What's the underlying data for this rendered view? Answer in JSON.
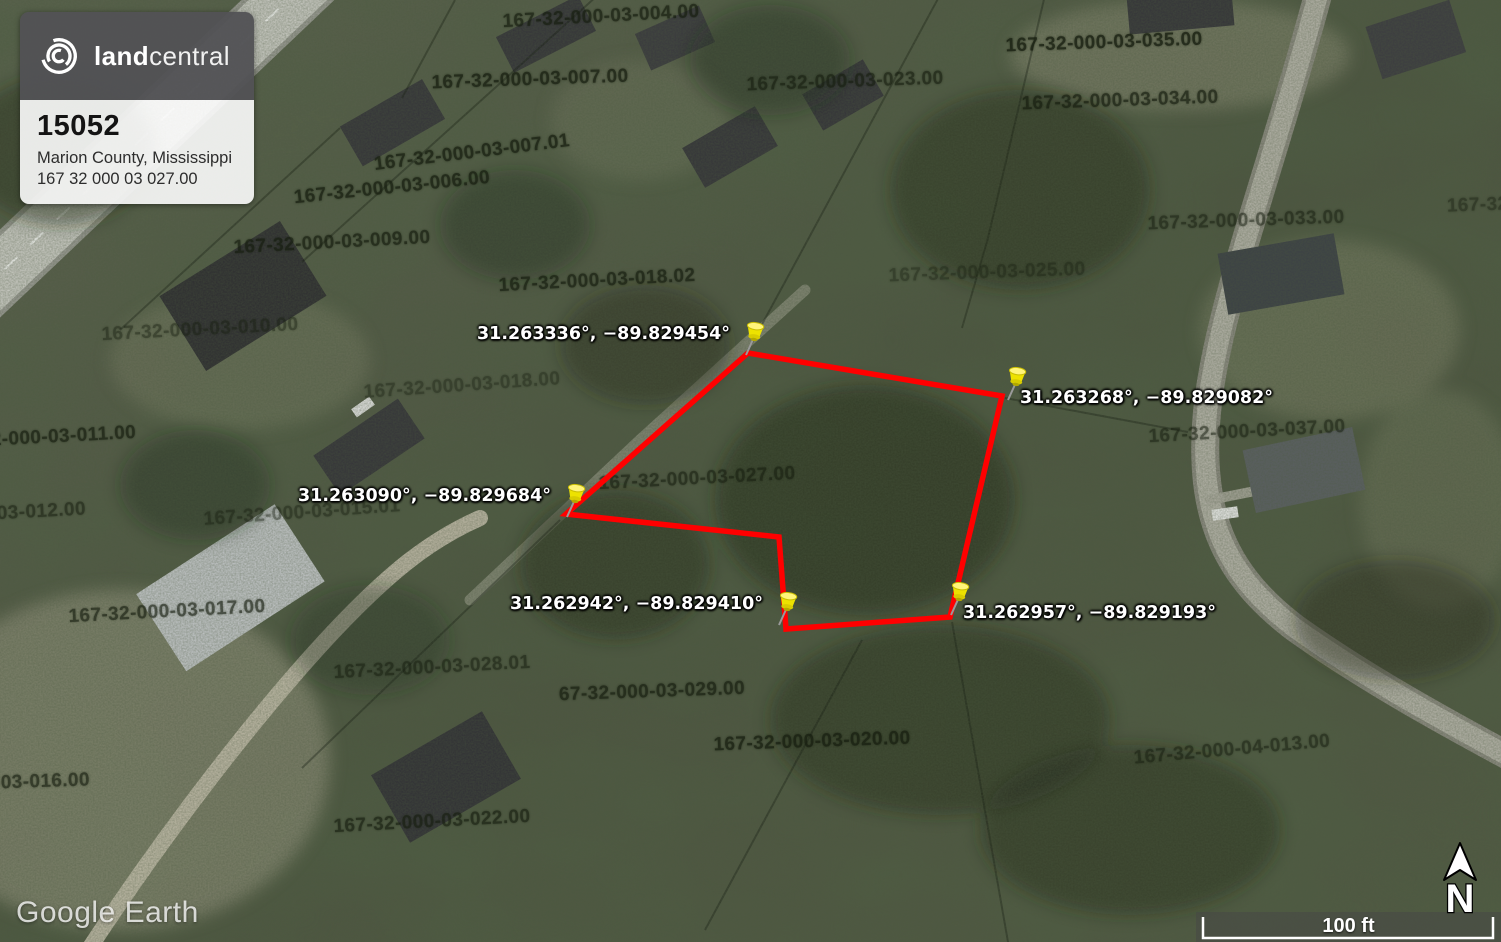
{
  "branding": {
    "logo_bold": "land",
    "logo_light": "central",
    "listing_id": "15052",
    "location": "Marion County, Mississippi",
    "apn": "167 32 000 03 027.00"
  },
  "map": {
    "watermark": "Google Earth",
    "scale_label": "100 ft",
    "north_label": "N",
    "boundary_color": "#ff0000",
    "pin_color": "#f2e400",
    "pins": [
      {
        "coords": "31.263336°, −89.829454°"
      },
      {
        "coords": "31.263268°, −89.829082°"
      },
      {
        "coords": "31.263090°, −89.829684°"
      },
      {
        "coords": "31.262942°, −89.829410°"
      },
      {
        "coords": "31.262957°, −89.829193°"
      }
    ],
    "parcel_labels": [
      "167-32-000-03-004.00",
      "167-32-000-03-007.00",
      "167-32-000-03-023.00",
      "167-32-000-03-035.00",
      "167-32-000-03-034.00",
      "167-32-000-03-007.01",
      "167-32-000-03-006.00",
      "167-32-000-03-009.00",
      "167-32-000-03-033.00",
      "167-32-000-03-025.00",
      "167-32-000-03-018.02",
      "167-32-000-03-010.00",
      "167-32-000-03-018.00",
      "32-000-03-011.00",
      "167-32-000-03-037.00",
      "167-32-000-03-027.00",
      "167-32-000-03-015.01",
      "-03-012.00",
      "167-32-000-03-017.00",
      "167-32-000-03-028.01",
      "67-32-000-03-029.00",
      "167-32-000-03-020.00",
      "167-32-000-04-013.00",
      "-03-016.00",
      "167-32-000-03-022.00",
      "167-32-00"
    ]
  }
}
